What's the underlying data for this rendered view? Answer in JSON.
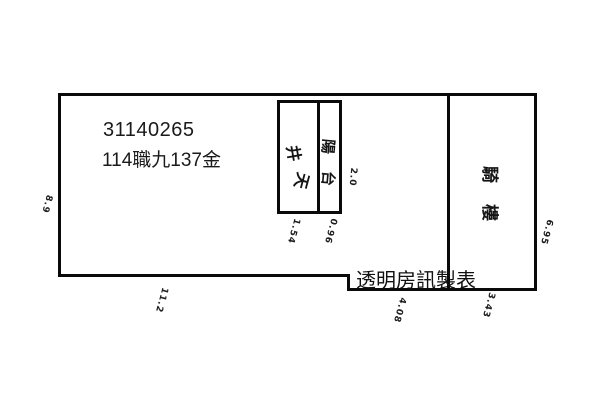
{
  "plan": {
    "id_number": "31140265",
    "parcel_label": "114職九137金",
    "watermark": "透明房訊製表",
    "rooms": {
      "lightwell": {
        "name": "天井",
        "chars": [
          "井",
          "天"
        ]
      },
      "balcony": {
        "name": "陽台",
        "chars": [
          "陽",
          "台"
        ]
      },
      "arcade": {
        "name": "騎樓",
        "chars": [
          "騎",
          "樓"
        ]
      }
    },
    "dimensions": [
      {
        "value": "8.9",
        "position": "outside-left-edge"
      },
      {
        "value": "11.2",
        "position": "below-bottom-left-edge"
      },
      {
        "value": "1.54",
        "position": "below-lightwell-cell"
      },
      {
        "value": "0.96",
        "position": "below-balcony-cell"
      },
      {
        "value": "2.0",
        "position": "right-of-balcony-box"
      },
      {
        "value": "4.08",
        "position": "below-bottom-middle-edge"
      },
      {
        "value": "3.43",
        "position": "below-arcade"
      },
      {
        "value": "6.95",
        "position": "right-of-arcade"
      }
    ],
    "colors": {
      "wall": "#0a0a0a",
      "background": "#ffffff",
      "text": "#1a1a1a"
    }
  }
}
